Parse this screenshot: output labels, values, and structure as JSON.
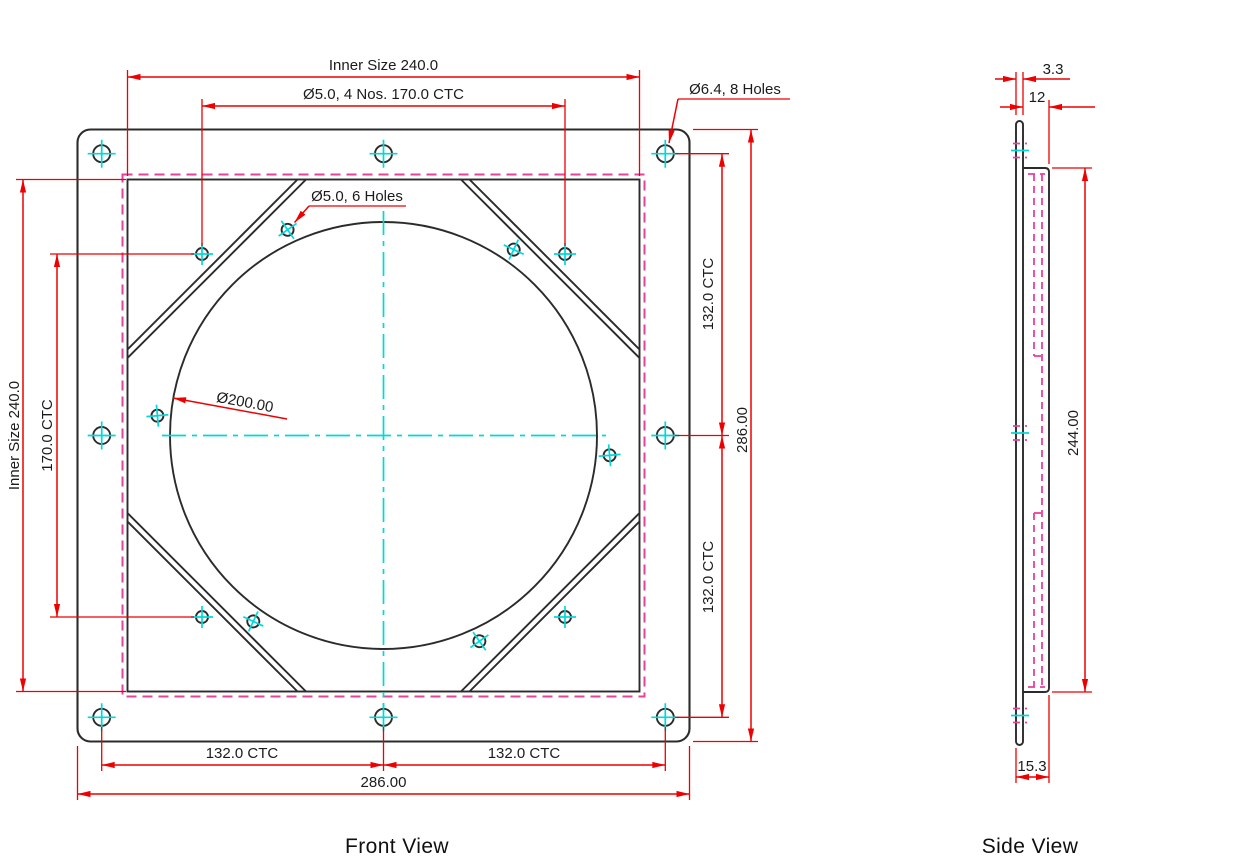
{
  "drawing": {
    "labels": {
      "front_view": "Front View",
      "side_view": "Side View"
    },
    "colors": {
      "background": "#ffffff",
      "outline": "#2b2b2b",
      "dimension_red": "#ee0000",
      "centerline_cyan": "#00d9d9",
      "hidden_magenta": "#e8409c",
      "text": "#1b1b1b"
    },
    "front": {
      "dim_inner_size_top": "Inner Size 240.0",
      "dim_holes_4": "Ø5.0, 4 Nos. 170.0 CTC",
      "callout_holes_8": "Ø6.4, 8 Holes",
      "callout_holes_6": "Ø5.0, 6 Holes",
      "callout_bore": "Ø200.00",
      "dim_ctc_right_top": "132.0 CTC",
      "dim_ctc_right_bottom": "132.0 CTC",
      "dim_overall_right": "286.00",
      "dim_inner_size_left": "Inner Size 240.0",
      "dim_ctc_left": "170.0 CTC",
      "dim_ctc_bottom_left": "132.0 CTC",
      "dim_ctc_bottom_right": "132.0 CTC",
      "dim_overall_bottom": "286.00"
    },
    "side": {
      "dim_flange_thickness": "3.3",
      "dim_body_thickness": "12",
      "dim_body_height": "244.00",
      "dim_total_thickness": "15.3"
    }
  }
}
